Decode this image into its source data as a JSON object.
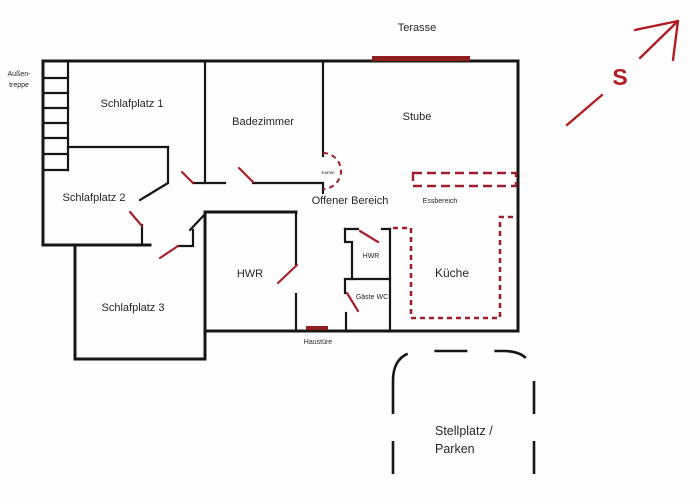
{
  "title": "Grundriss / floor plan sketch",
  "colors": {
    "wall": "#161616",
    "door_swing_red": "#a8202c",
    "furniture_dash_red": "#9c1f2e",
    "entry_bar_red": "#8f1f1f",
    "compass_red": "#b01e24",
    "text": "#262626"
  },
  "labels": {
    "terasse": "Terasse",
    "aussentreppe_line1": "Außen-",
    "aussentreppe_line2": "treppe",
    "schlafplatz1": "Schlafplatz 1",
    "badezimmer": "Badezimmer",
    "stube": "Stube",
    "schlafplatz2": "Schlafplatz 2",
    "offener_bereich": "Offener Bereich",
    "essbereich": "Essbereich",
    "schlafplatz3": "Schlafplatz 3",
    "hwr_main": "HWR",
    "hwr_small": "HWR",
    "kueche": "Küche",
    "gaeste_wc": "Gäste WC",
    "haustuere": "Haustüre",
    "kamin": "Kamin",
    "stellplatz_line1": "Stellplatz /",
    "stellplatz_line2": "Parken",
    "compass_s": "S"
  }
}
